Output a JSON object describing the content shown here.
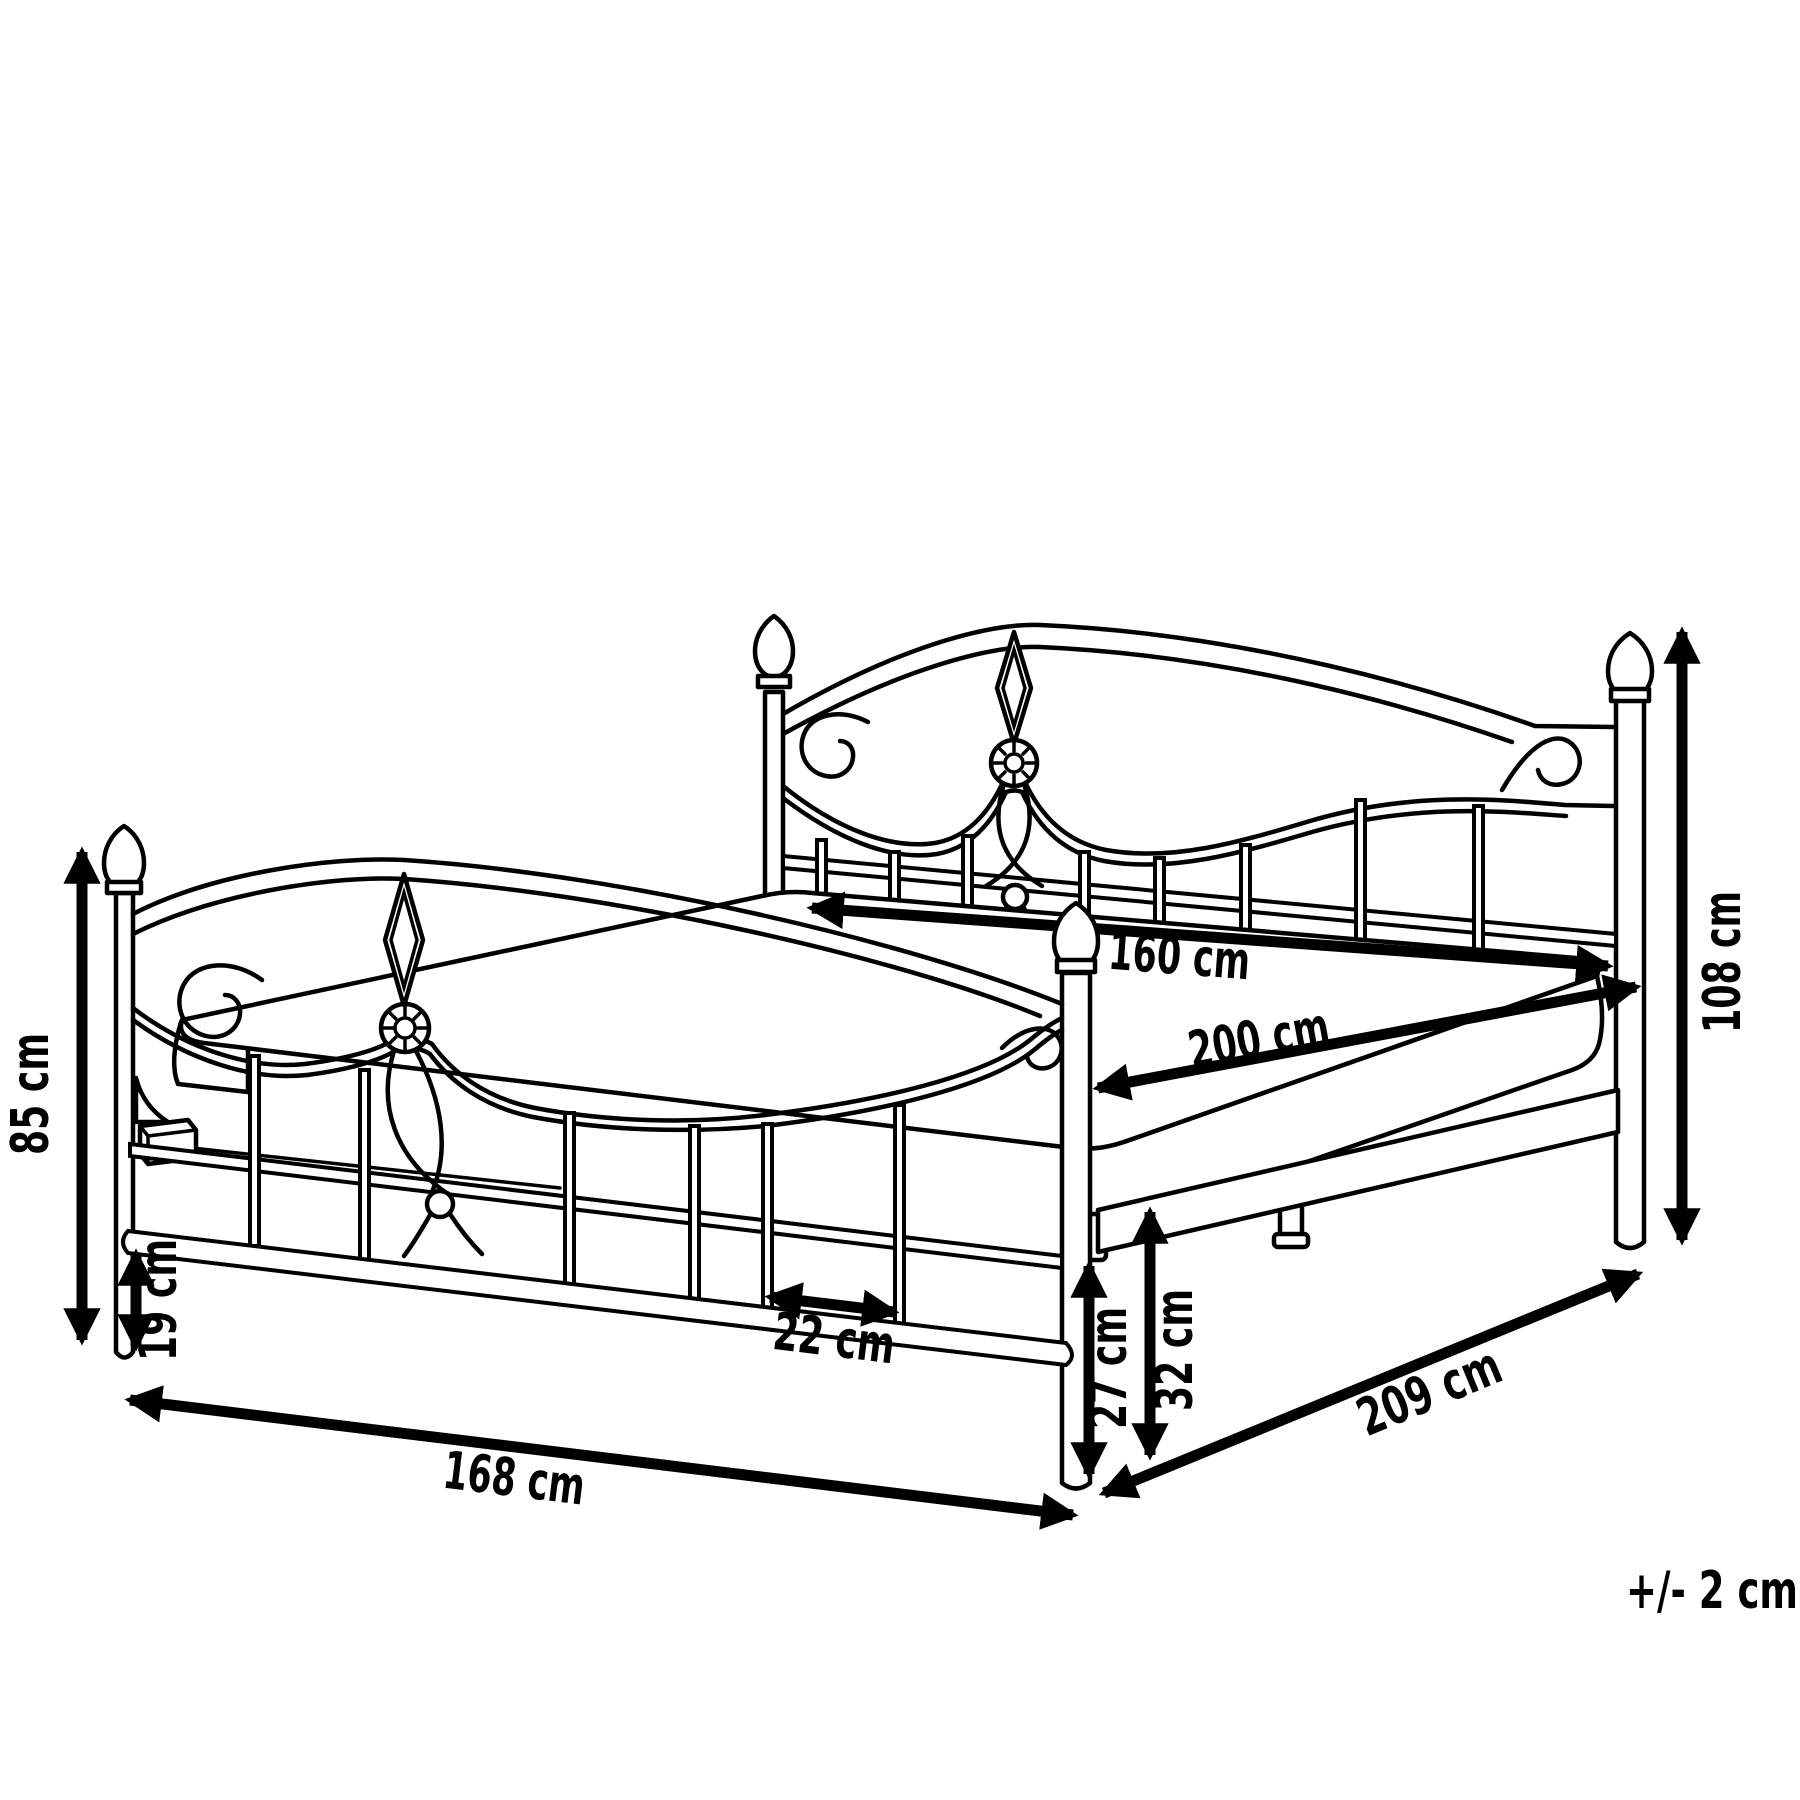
{
  "diagram": {
    "subject": "bed-frame-with-dimensions",
    "unit": "cm",
    "colors": {
      "line": "#000000",
      "background": "#ffffff",
      "label": "#000000"
    },
    "dims": {
      "d85": {
        "label": "85 cm",
        "value": 85
      },
      "d19": {
        "label": "19 cm",
        "value": 19
      },
      "d168": {
        "label": "168 cm",
        "value": 168
      },
      "d22": {
        "label": "22 cm",
        "value": 22
      },
      "d160": {
        "label": "160 cm",
        "value": 160
      },
      "d200": {
        "label": "200 cm",
        "value": 200
      },
      "d108": {
        "label": "108 cm",
        "value": 108
      },
      "d27": {
        "label": "27 cm",
        "value": 27
      },
      "d32": {
        "label": "32 cm",
        "value": 32
      },
      "d209": {
        "label": "209 cm",
        "value": 209
      },
      "tolerance": {
        "label": "+/- 2 cm",
        "value": 2
      }
    }
  }
}
